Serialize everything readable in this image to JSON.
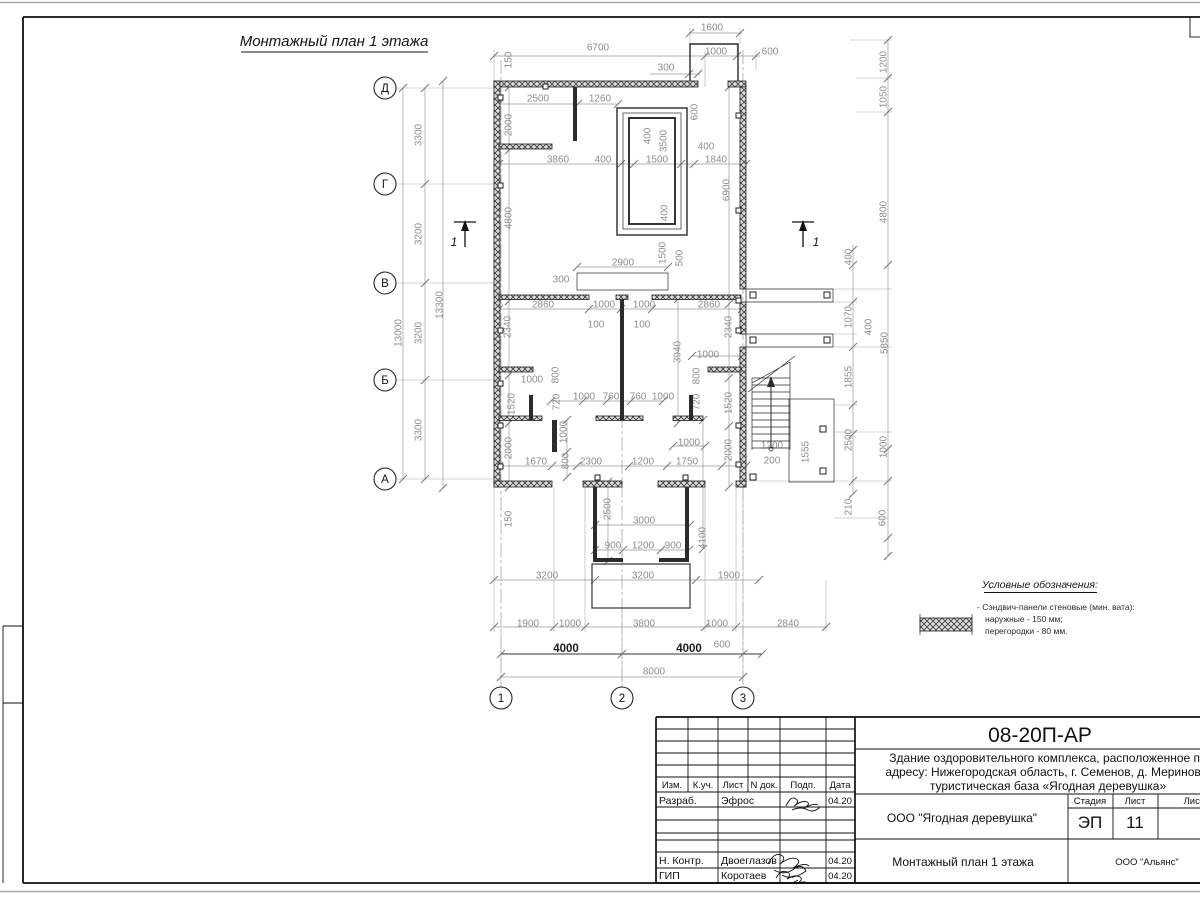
{
  "sheet": {
    "drawing_title": "Монтажный план 1 этажа",
    "section_mark": "1"
  },
  "axes": {
    "rows": [
      {
        "label": "Д",
        "x": 385,
        "y": 88
      },
      {
        "label": "Г",
        "x": 385,
        "y": 184
      },
      {
        "label": "В",
        "x": 385,
        "y": 283
      },
      {
        "label": "Б",
        "x": 385,
        "y": 380
      },
      {
        "label": "А",
        "x": 385,
        "y": 479
      }
    ],
    "cols": [
      {
        "label": "1",
        "x": 501,
        "y": 698
      },
      {
        "label": "2",
        "x": 622,
        "y": 698
      },
      {
        "label": "3",
        "x": 743,
        "y": 698
      }
    ]
  },
  "dim_labels": [
    [
      "1600",
      712,
      28,
      0
    ],
    [
      "6700",
      598,
      48,
      0
    ],
    [
      "1000",
      716,
      52,
      0
    ],
    [
      "600",
      770,
      52,
      0
    ],
    [
      "300",
      666,
      68,
      0
    ],
    [
      "2500",
      538,
      99,
      0
    ],
    [
      "1260",
      600,
      99,
      0
    ],
    [
      "150",
      509,
      60,
      1
    ],
    [
      "2000",
      509,
      125,
      1
    ],
    [
      "600",
      695,
      112,
      1
    ],
    [
      "400",
      648,
      136,
      1
    ],
    [
      "3500",
      664,
      141,
      1
    ],
    [
      "3860",
      558,
      160,
      0
    ],
    [
      "400",
      603,
      160,
      0
    ],
    [
      "1500",
      657,
      160,
      0
    ],
    [
      "400",
      706,
      147,
      0
    ],
    [
      "1840",
      716,
      160,
      0
    ],
    [
      "6900",
      727,
      190,
      1
    ],
    [
      "4800",
      509,
      218,
      1
    ],
    [
      "400",
      665,
      213,
      1
    ],
    [
      "1500",
      663,
      253,
      1
    ],
    [
      "500",
      680,
      258,
      1
    ],
    [
      "2900",
      623,
      263,
      0
    ],
    [
      "300",
      561,
      280,
      0
    ],
    [
      "2860",
      543,
      305,
      0
    ],
    [
      "1000",
      604,
      305,
      0
    ],
    [
      "1000",
      644,
      305,
      0
    ],
    [
      "2860",
      709,
      305,
      0
    ],
    [
      "100",
      596,
      325,
      0
    ],
    [
      "100",
      642,
      325,
      0
    ],
    [
      "2340",
      508,
      327,
      1
    ],
    [
      "2340",
      729,
      327,
      1
    ],
    [
      "3940",
      678,
      352,
      1
    ],
    [
      "1000",
      708,
      355,
      0
    ],
    [
      "1000",
      532,
      380,
      0
    ],
    [
      "800",
      556,
      375,
      1
    ],
    [
      "720",
      557,
      402,
      1
    ],
    [
      "1520",
      512,
      404,
      1
    ],
    [
      "1000",
      584,
      397,
      0
    ],
    [
      "760",
      611,
      397,
      0
    ],
    [
      "760",
      638,
      397,
      0
    ],
    [
      "1000",
      663,
      397,
      0
    ],
    [
      "800",
      697,
      376,
      1
    ],
    [
      "720",
      697,
      402,
      1
    ],
    [
      "1520",
      729,
      403,
      1
    ],
    [
      "1000",
      564,
      432,
      1
    ],
    [
      "1000",
      689,
      443,
      0
    ],
    [
      "2000",
      509,
      448,
      1
    ],
    [
      "800",
      566,
      461,
      1
    ],
    [
      "1670",
      536,
      462,
      0
    ],
    [
      "2300",
      591,
      462,
      0
    ],
    [
      "1200",
      643,
      462,
      0
    ],
    [
      "1750",
      687,
      462,
      0
    ],
    [
      "2000",
      729,
      450,
      1
    ],
    [
      "1200",
      772,
      446,
      0
    ],
    [
      "200",
      772,
      461,
      0
    ],
    [
      "1555",
      806,
      452,
      1
    ],
    [
      "150",
      509,
      519,
      1
    ],
    [
      "2500",
      608,
      509,
      1
    ],
    [
      "3000",
      644,
      521,
      0
    ],
    [
      "900",
      613,
      546,
      0
    ],
    [
      "1200",
      643,
      546,
      0
    ],
    [
      "900",
      673,
      546,
      0
    ],
    [
      "4100",
      703,
      538,
      1
    ],
    [
      "3200",
      547,
      576,
      0
    ],
    [
      "3200",
      643,
      576,
      0
    ],
    [
      "1900",
      729,
      576,
      0
    ],
    [
      "1900",
      528,
      624,
      0
    ],
    [
      "1000",
      570,
      624,
      0
    ],
    [
      "3800",
      644,
      624,
      0
    ],
    [
      "1000",
      717,
      624,
      0
    ],
    [
      "2840",
      788,
      624,
      0
    ],
    [
      "4000",
      566,
      649,
      0,
      1
    ],
    [
      "4000",
      689,
      649,
      0,
      1
    ],
    [
      "600",
      722,
      645,
      0
    ],
    [
      "8000",
      654,
      672,
      0
    ],
    [
      "3300",
      419,
      135,
      1
    ],
    [
      "3200",
      419,
      234,
      1
    ],
    [
      "3200",
      419,
      333,
      1
    ],
    [
      "3300",
      419,
      430,
      1
    ],
    [
      "13000",
      399,
      333,
      1
    ],
    [
      "13300",
      440,
      305,
      1
    ],
    [
      "1200",
      884,
      62,
      1
    ],
    [
      "1050",
      884,
      97,
      1
    ],
    [
      "4800",
      884,
      212,
      1
    ],
    [
      "400",
      849,
      257,
      1
    ],
    [
      "1070",
      849,
      317,
      1
    ],
    [
      "400",
      869,
      327,
      1
    ],
    [
      "5850",
      885,
      343,
      1
    ],
    [
      "1855",
      849,
      377,
      1
    ],
    [
      "2500",
      849,
      440,
      1
    ],
    [
      "1000",
      884,
      447,
      1
    ],
    [
      "210",
      849,
      507,
      1
    ],
    [
      "600",
      883,
      518,
      1
    ]
  ],
  "ticks": [
    [
      494,
      56
    ],
    [
      705,
      56
    ],
    [
      737,
      56
    ],
    [
      756,
      56
    ],
    [
      690,
      33
    ],
    [
      740,
      33
    ],
    [
      689,
      74
    ],
    [
      698,
      74
    ],
    [
      499,
      104
    ],
    [
      578,
      104
    ],
    [
      618,
      104
    ],
    [
      499,
      164
    ],
    [
      621,
      164
    ],
    [
      634,
      164
    ],
    [
      681,
      164
    ],
    [
      694,
      164
    ],
    [
      746,
      164
    ],
    [
      499,
      309
    ],
    [
      589,
      309
    ],
    [
      621,
      309
    ],
    [
      652,
      309
    ],
    [
      742,
      309
    ],
    [
      551,
      401
    ],
    [
      583,
      401
    ],
    [
      607,
      401
    ],
    [
      631,
      401
    ],
    [
      663,
      401
    ],
    [
      499,
      466
    ],
    [
      552,
      466
    ],
    [
      577,
      466
    ],
    [
      629,
      466
    ],
    [
      667,
      466
    ],
    [
      722,
      466
    ],
    [
      746,
      466
    ],
    [
      692,
      356
    ],
    [
      742,
      356
    ],
    [
      673,
      446
    ],
    [
      705,
      446
    ],
    [
      577,
      267
    ],
    [
      668,
      267
    ],
    [
      595,
      525
    ],
    [
      690,
      525
    ],
    [
      595,
      550
    ],
    [
      623,
      550
    ],
    [
      661,
      550
    ],
    [
      689,
      550
    ],
    [
      494,
      580
    ],
    [
      595,
      580
    ],
    [
      696,
      580
    ],
    [
      759,
      580
    ],
    [
      494,
      627
    ],
    [
      554,
      627
    ],
    [
      585,
      627
    ],
    [
      705,
      627
    ],
    [
      736,
      627
    ],
    [
      826,
      627
    ],
    [
      501,
      654
    ],
    [
      622,
      654
    ],
    [
      743,
      654
    ],
    [
      762,
      654
    ],
    [
      501,
      677
    ],
    [
      743,
      677
    ],
    [
      425,
      88
    ],
    [
      425,
      184
    ],
    [
      425,
      283
    ],
    [
      425,
      380
    ],
    [
      425,
      479
    ],
    [
      403,
      88
    ],
    [
      403,
      479
    ],
    [
      443,
      81
    ],
    [
      443,
      488
    ],
    [
      509,
      87
    ],
    [
      509,
      150
    ],
    [
      509,
      301
    ],
    [
      509,
      375
    ],
    [
      509,
      423
    ],
    [
      509,
      487
    ],
    [
      729,
      87
    ],
    [
      729,
      304
    ],
    [
      729,
      378
    ],
    [
      729,
      426
    ],
    [
      729,
      487
    ],
    [
      678,
      299
    ],
    [
      678,
      423
    ],
    [
      703,
      420
    ],
    [
      703,
      549
    ],
    [
      608,
      482
    ],
    [
      608,
      561
    ],
    [
      567,
      420
    ],
    [
      567,
      452
    ],
    [
      567,
      477
    ],
    [
      853,
      250
    ],
    [
      853,
      265
    ],
    [
      853,
      302
    ],
    [
      853,
      347
    ],
    [
      853,
      405
    ],
    [
      853,
      434
    ],
    [
      853,
      481
    ],
    [
      853,
      494
    ],
    [
      888,
      40
    ],
    [
      888,
      78
    ],
    [
      888,
      112
    ],
    [
      888,
      265
    ],
    [
      888,
      449
    ],
    [
      888,
      481
    ],
    [
      888,
      538
    ],
    [
      888,
      556
    ]
  ],
  "legend": {
    "title": "Условные обозначения:",
    "item_line1": "- Сэндвич-панели стеновые (мин. вата):",
    "item_line2": "наружные - 150 мм;",
    "item_line3": "перегородки - 80 мм."
  },
  "title_block": {
    "code": "08-20П-АР",
    "project_line1": "Здание оздоровительного комплекса, расположенное по",
    "project_line2": "адресу: Нижегородская область, г. Семенов, д. Мериново,",
    "project_line3": "туристическая база «Ягодная деревушка»",
    "client": "ООО \"Ягодная деревушка\"",
    "sheet_title": "Монтажный план 1 этажа",
    "org": "ООО \"Альянс\"",
    "stage_label": "Стадия",
    "sheet_label": "Лист",
    "sheets_label": "Листов",
    "stage": "ЭП",
    "sheet_no": "11",
    "col_headers": [
      "Изм.",
      "К.уч.",
      "Лист",
      "N док.",
      "Подп.",
      "Дата"
    ],
    "rows": [
      {
        "role": "Разраб.",
        "name": "Эфрос",
        "date": "04.20"
      },
      {
        "role": "Н. Контр.",
        "name": "Двоеглазов",
        "date": "04.20"
      },
      {
        "role": "ГИП",
        "name": "Коротаев",
        "date": "04.20"
      }
    ]
  }
}
